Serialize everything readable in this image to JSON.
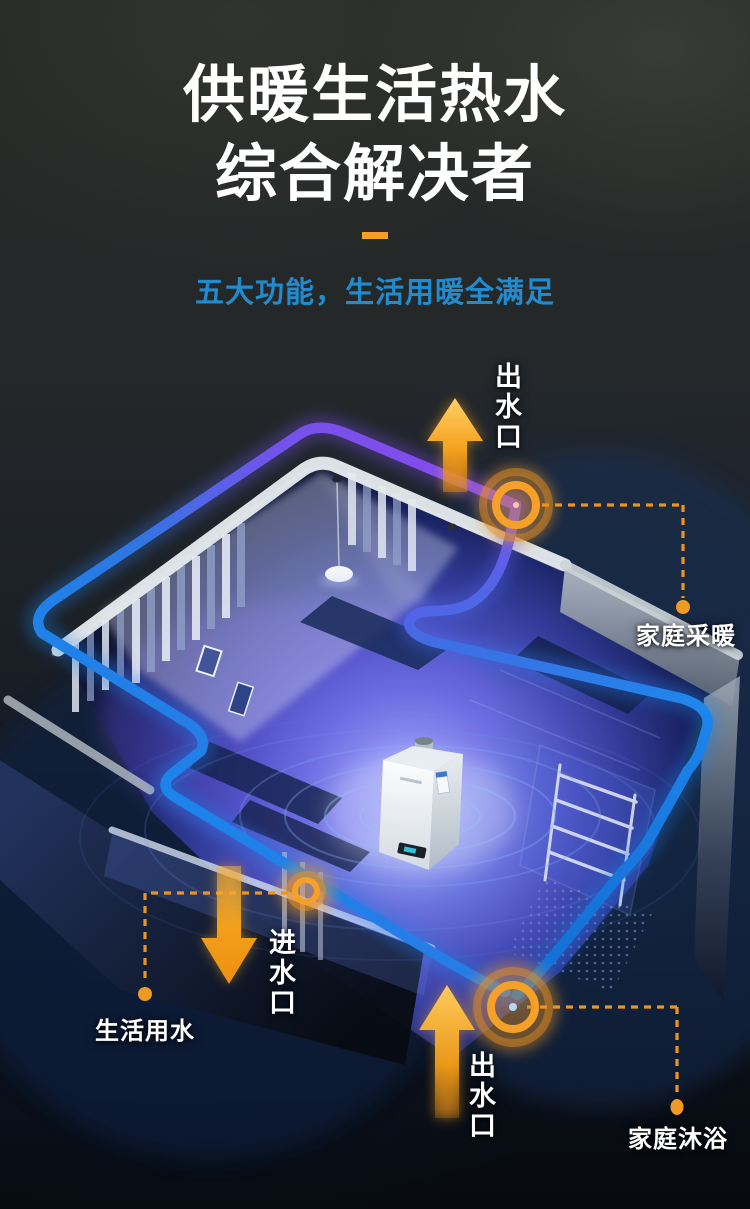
{
  "header": {
    "title_line1": "供暖生活热水",
    "title_line2": "综合解决者",
    "subtitle": "五大功能，生活用暖全满足"
  },
  "annotations": {
    "outlet_top": "出水口",
    "heating": "家庭采暖",
    "inlet": "进水口",
    "domestic_water": "生活用水",
    "outlet_bottom": "出水口",
    "bath": "家庭沐浴"
  },
  "colors": {
    "accent_orange": "#F5A021",
    "dashed_orange": "#EE9220",
    "subtitle_blue": "#218BCE",
    "pipe_purple": "#8B44EE",
    "pipe_blue": "#1E7FE8",
    "title_white": "#FFFFFF"
  },
  "icons": {
    "flow_up_arrow": "▲",
    "flow_down_arrow": "▼",
    "port_ring_marker": "◎",
    "leader_dot": "●"
  }
}
